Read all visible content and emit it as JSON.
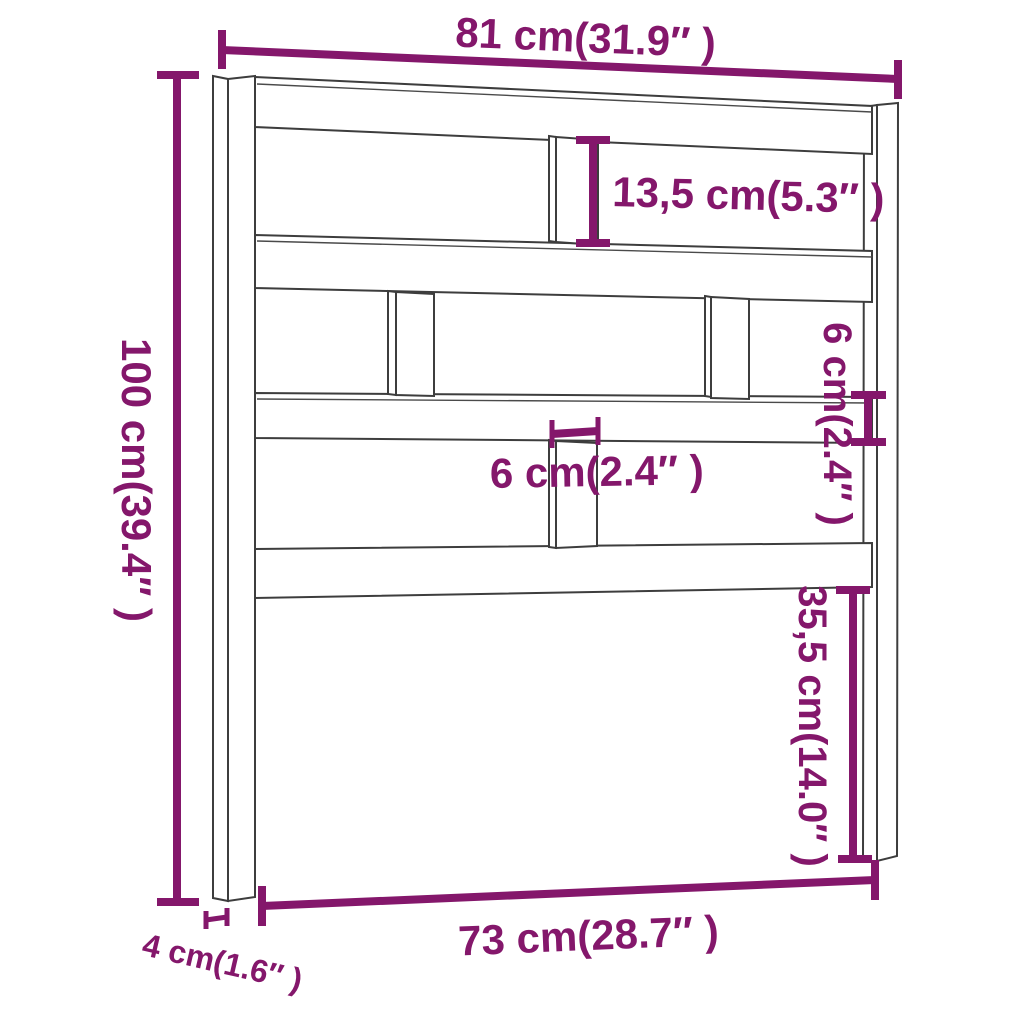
{
  "figure": {
    "type": "product-dimension-diagram",
    "subject": "bed headboard line drawing",
    "colors": {
      "dimension_accent": "#84176b",
      "outline": "#3d3d3d",
      "background": "#ffffff"
    },
    "labels": {
      "overall_width": "81 cm(31.9″ )",
      "upper_gap_height": "13,5 cm(5.3″ )",
      "overall_height": "100 cm(39.4″ )",
      "rail_thickness": "6 cm(2.4″ )",
      "slat_width": "6 cm(2.4″ )",
      "lower_section_height": "35,5 cm(14.0″ )",
      "inner_width": "73 cm(28.7″ )",
      "leg_depth": "4 cm(1.6″ )"
    }
  }
}
